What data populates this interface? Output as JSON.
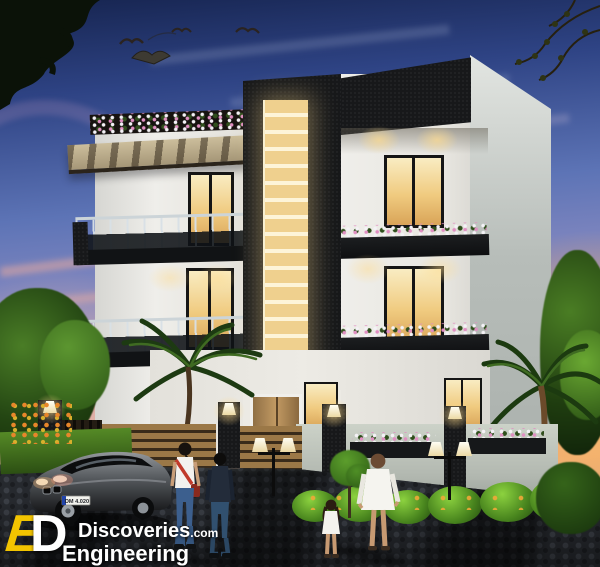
{
  "watermark": {
    "monogram_e": "E",
    "monogram_d": "D",
    "brand": "Discoveries",
    "brand_suffix": ".com",
    "subtitle": "Engineering"
  },
  "car": {
    "plate": "DM 4.020"
  },
  "palette": {
    "sky_top": "#1c2b5e",
    "sky_mid": "#5d74b6",
    "sky_lavender": "#a393c8",
    "sunset_orange": "#f49a3e",
    "wall_white": "#ebe9e3",
    "side_wall_gray": "#b9bfbb",
    "charcoal": "#17181a",
    "window_glow": "#f0cb80",
    "louver_amber": "#efd08e",
    "gate_wood": "#9b7847",
    "foliage_green": "#5cae2e",
    "flower_pink": "#e08fc2",
    "logo_yellow": "#f2c400"
  }
}
